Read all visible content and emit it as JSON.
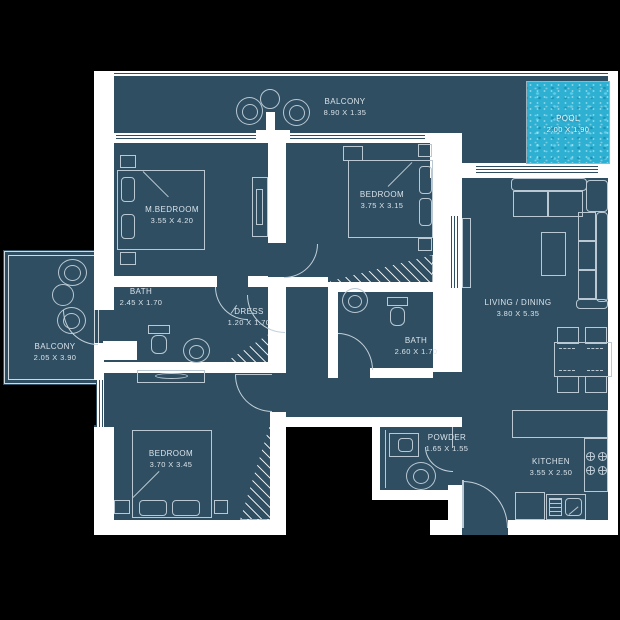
{
  "title": "apartment-floor-plan",
  "colors": {
    "background": "#000000",
    "floor": "#2f4e62",
    "wall": "#ffffff",
    "furniture_line": "#b9c8d2",
    "label_text": "#d9e3ea",
    "pool_water": "#2eb0d3"
  },
  "rooms": [
    {
      "id": "balcony-top",
      "name": "BALCONY",
      "dims": "8.90 X 1.35"
    },
    {
      "id": "pool",
      "name": "POOL",
      "dims": "2.00 X 1.90"
    },
    {
      "id": "master-bedroom",
      "name": "M.BEDROOM",
      "dims": "3.55 X 4.20"
    },
    {
      "id": "bedroom-2",
      "name": "BEDROOM",
      "dims": "3.75 X 3.15"
    },
    {
      "id": "bath-1",
      "name": "BATH",
      "dims": "2.45 X 1.70"
    },
    {
      "id": "dress",
      "name": "DRESS",
      "dims": "1.20 X 1.70"
    },
    {
      "id": "balcony-left",
      "name": "BALCONY",
      "dims": "2.05 X 3.90"
    },
    {
      "id": "bedroom-3",
      "name": "BEDROOM",
      "dims": "3.70 X 3.45"
    },
    {
      "id": "bath-2",
      "name": "BATH",
      "dims": "2.60 X 1.70"
    },
    {
      "id": "living-dining",
      "name": "LIVING / DINING",
      "dims": "3.80 X 5.35"
    },
    {
      "id": "powder",
      "name": "POWDER",
      "dims": "1.65 X 1.55"
    },
    {
      "id": "kitchen",
      "name": "KITCHEN",
      "dims": "3.55 X 2.50"
    }
  ]
}
